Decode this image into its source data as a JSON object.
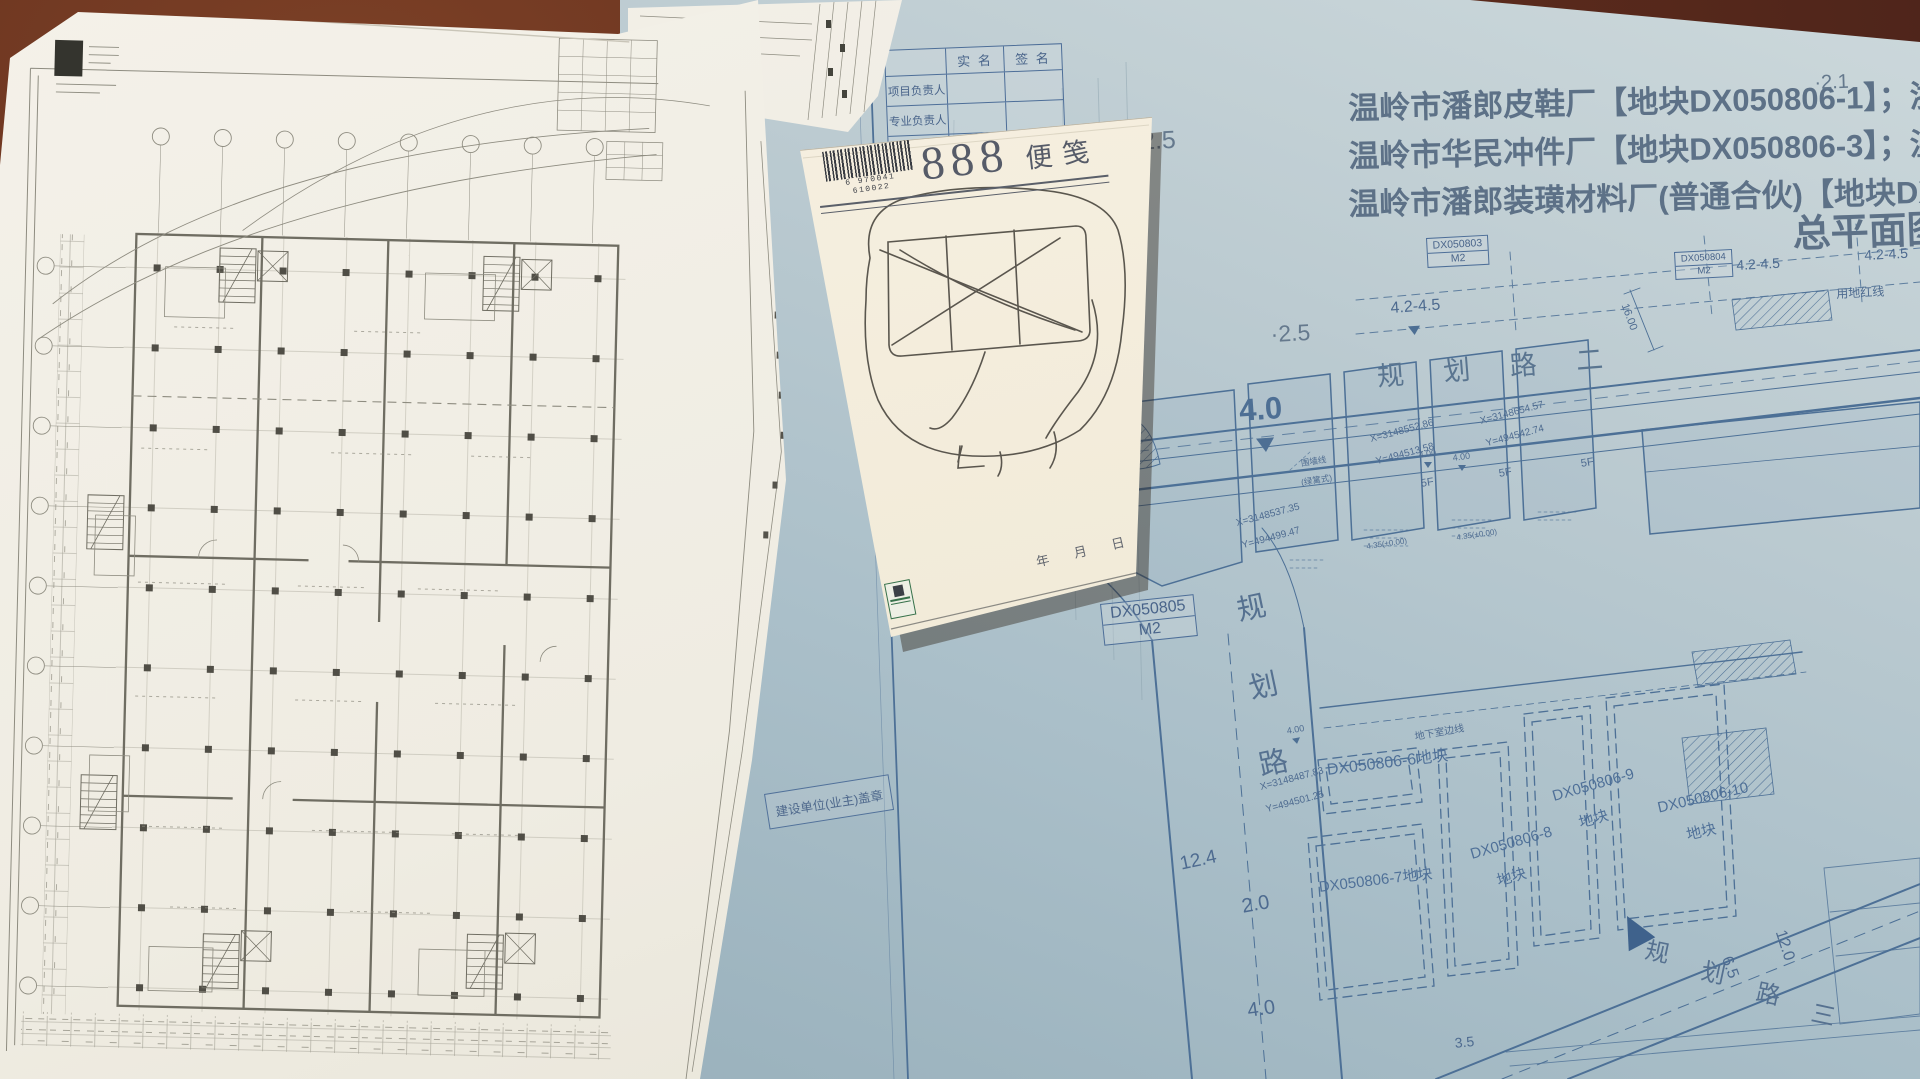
{
  "blueprint": {
    "signature_table": {
      "header_col1": "实  名",
      "header_col2": "签  名",
      "row1": "项目负责人",
      "row2": "专业负责人"
    },
    "title": {
      "line1": "温岭市潘郎皮鞋厂【地块DX050806-1】；浙江振邦机电有",
      "line2": "温岭市华民冲件厂【地块DX050806-3】；温岭市潘郎相公",
      "line3": "温岭市潘郎装璜材料厂(普通合伙)【地块DX050806-5】",
      "main": "总平面图"
    },
    "parcel_tags": {
      "tag803": {
        "code": "DX050803",
        "unit": "M2"
      },
      "tag804": {
        "code": "DX050804",
        "unit": "M2"
      },
      "tag805": {
        "code": "DX050805",
        "unit": "M2"
      }
    },
    "spot_elevations": {
      "a": "·2.5",
      "b": "·2.5",
      "c": "·2.1"
    },
    "elevation_ranges": {
      "a": "4.2-4.5",
      "b": "4.2-4.5",
      "c": "4.2-4.5"
    },
    "roads": {
      "east_west": "规 划 路 二",
      "north_south": {
        "c1": "规",
        "c2": "划",
        "c3": "路"
      },
      "south_east": {
        "c1": "规",
        "c2": "划",
        "c3": "路",
        "c4": "三"
      }
    },
    "levels": {
      "big40": "4.0",
      "l400a": "4.00",
      "l400b": "4.00",
      "l400c": "4.00",
      "l20": "2.0",
      "l40b": "4.0",
      "l124": "12.4",
      "l65": "6.5",
      "l120": "12.0",
      "l1600": "16.00",
      "l35": "3.5",
      "l435a": "4.35(±0.00)",
      "l435b": "4.35(±0.00)"
    },
    "coordinates": {
      "p1": {
        "x": "X=3148552.86",
        "y": "Y=494513.58"
      },
      "p2": {
        "x": "X=3148654.57",
        "y": "Y=494542.74"
      },
      "p3": {
        "x": "X=3148537.35",
        "y": "Y=494499.47"
      },
      "p4": {
        "x": "X=3148487.83",
        "y": "Y=494501.25"
      }
    },
    "notes": {
      "fence1": "围墙线",
      "fence2": "(绿篱式)",
      "basement": "地下室边线",
      "redline": "用地红线",
      "f5": "5F",
      "f1": "1F",
      "seal_box": "建设单位(业主)盖章"
    },
    "plots": {
      "p6": "DX050806-6地块",
      "p7": "DX050806-7地块",
      "p8_line1": "DX050806-8",
      "p8_line2": "地块",
      "p9_line1": "DX050806-9",
      "p9_line2": "地块",
      "p10_line1": "DX050806-10",
      "p10_line2": "地块"
    }
  },
  "notepad": {
    "brand_number": "888",
    "brand_text": "便笺",
    "barcode_number": "6 970041 610022",
    "date_fields": "年  月  日"
  }
}
